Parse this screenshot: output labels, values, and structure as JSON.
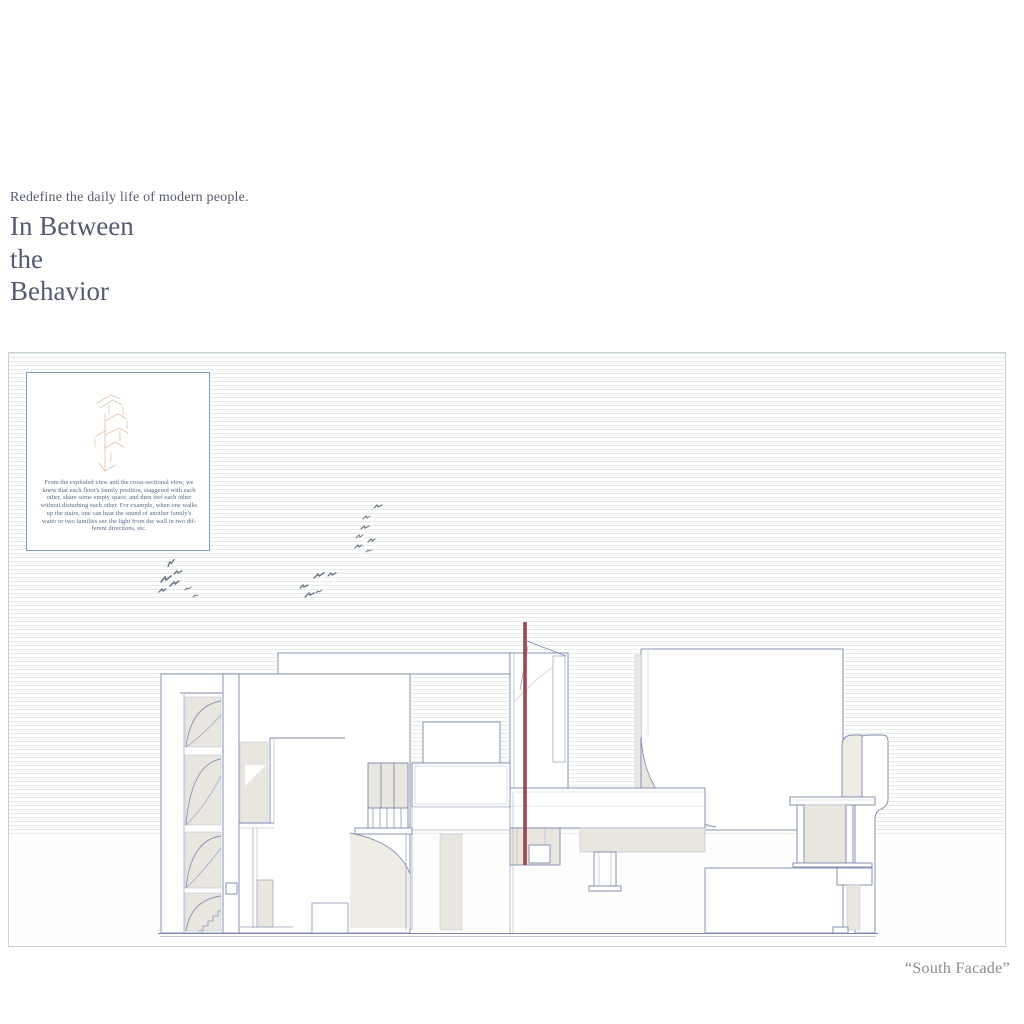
{
  "header": {
    "subtitle": "Redefine the daily life of modern people.",
    "title_lines": [
      "In Between",
      "the",
      "Behavior"
    ]
  },
  "board": {
    "note_lines": [
      "From the exploded view and the cross-sectional view, we",
      "knew that each floor's family position, staggered with each",
      "other, share some empty space, and then feel each other",
      "without disturbing each other. For example, when one walks",
      "up the stairs, one can hear the sound of another family's",
      "water or two families see the light from the wall in two dif-",
      "ferent directions, etc."
    ],
    "caption": "“South Facade”"
  },
  "drawing": {
    "subject": "south-facade-elevation",
    "elements": [
      "exploded-view-sketch",
      "bird-flocks",
      "flag-pole",
      "stair-tower",
      "balcony",
      "ground-line"
    ]
  },
  "colors": {
    "title_text": "#565a73",
    "caption_text": "#87899a",
    "drawing_line": "#7d88ac",
    "accent_red": "#9c4852",
    "fill_beige": "#e9e6df",
    "ruled_line": "#e6ede9",
    "note_border": "#76a0c4",
    "note_text": "#5a6a88",
    "bird": "#6b7386",
    "sketch_salmon": "#e2bfa8"
  }
}
